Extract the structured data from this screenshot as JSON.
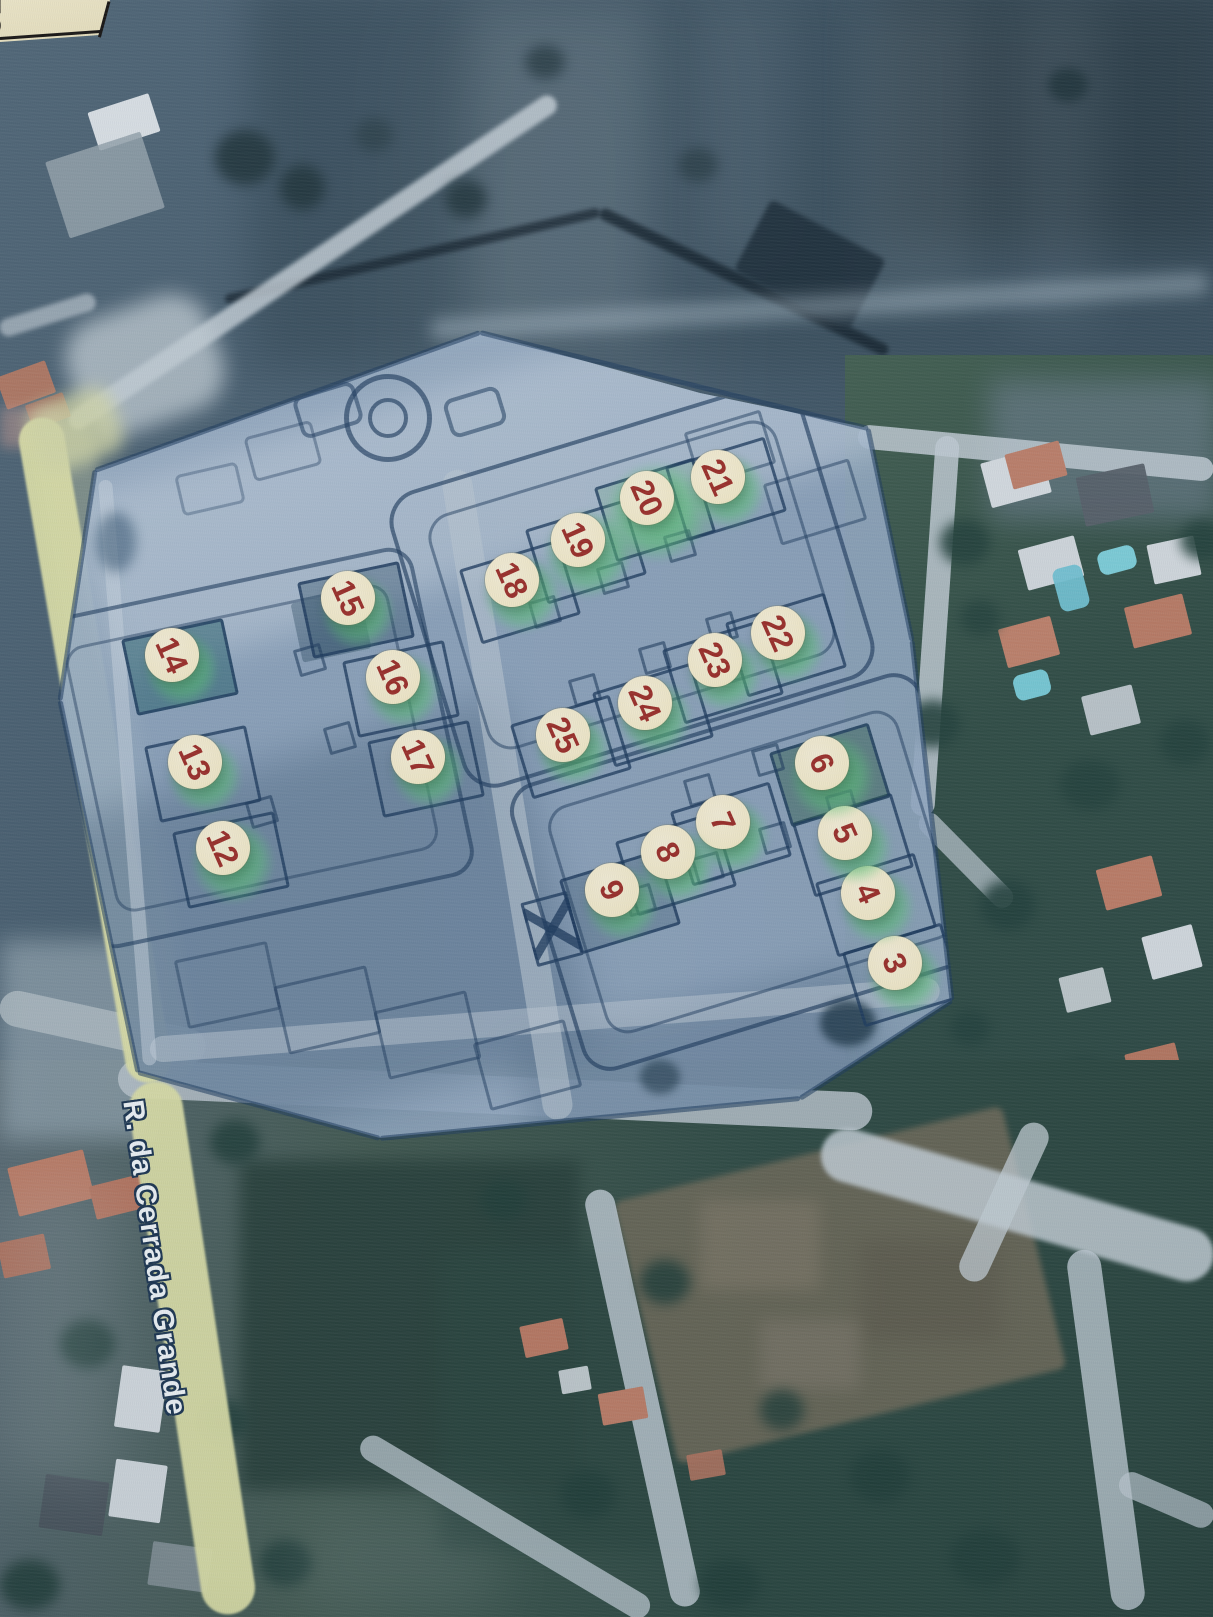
{
  "map": {
    "street_label": "R. da Cerrada Grande",
    "corner_note_text": "TO",
    "marker_fill": "#f6ecca",
    "marker_number_color": "#9e2d27",
    "highlight_color": "#5ec878",
    "plan_line_color": "#1e3a5c",
    "markers": [
      {
        "label": "3",
        "x": 895,
        "y": 963
      },
      {
        "label": "4",
        "x": 868,
        "y": 893
      },
      {
        "label": "5",
        "x": 845,
        "y": 833
      },
      {
        "label": "6",
        "x": 822,
        "y": 763
      },
      {
        "label": "7",
        "x": 723,
        "y": 822
      },
      {
        "label": "8",
        "x": 668,
        "y": 852
      },
      {
        "label": "9",
        "x": 612,
        "y": 890
      },
      {
        "label": "12",
        "x": 223,
        "y": 848
      },
      {
        "label": "13",
        "x": 195,
        "y": 762
      },
      {
        "label": "14",
        "x": 172,
        "y": 655
      },
      {
        "label": "15",
        "x": 348,
        "y": 598
      },
      {
        "label": "16",
        "x": 393,
        "y": 677
      },
      {
        "label": "17",
        "x": 418,
        "y": 757
      },
      {
        "label": "18",
        "x": 512,
        "y": 580
      },
      {
        "label": "19",
        "x": 578,
        "y": 540
      },
      {
        "label": "20",
        "x": 647,
        "y": 498
      },
      {
        "label": "21",
        "x": 718,
        "y": 477
      },
      {
        "label": "22",
        "x": 778,
        "y": 633
      },
      {
        "label": "23",
        "x": 715,
        "y": 660
      },
      {
        "label": "24",
        "x": 645,
        "y": 703
      },
      {
        "label": "25",
        "x": 563,
        "y": 735
      }
    ]
  }
}
